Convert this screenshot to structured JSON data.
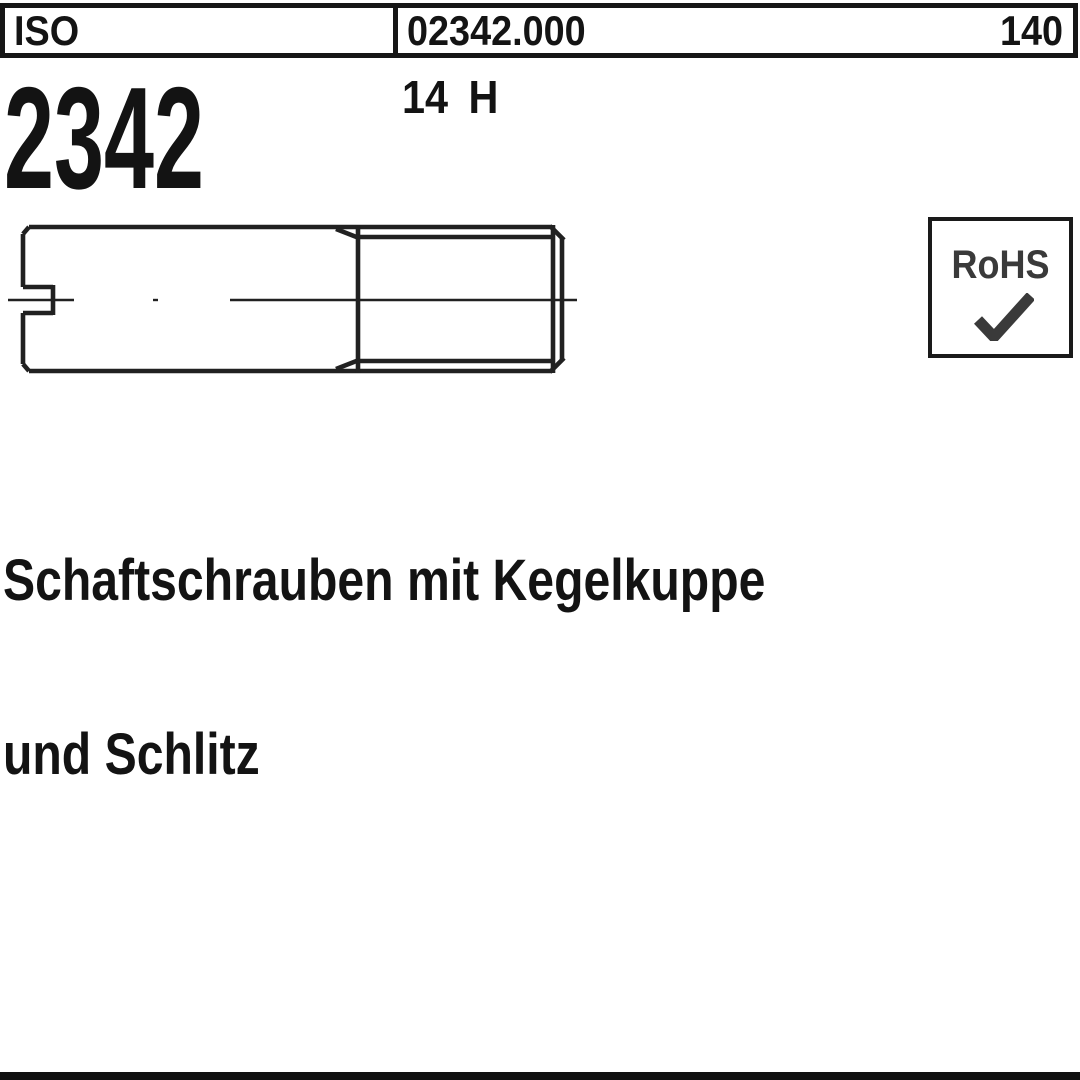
{
  "header": {
    "standard_org": "ISO",
    "article_number": "02342.000",
    "page_number": "140"
  },
  "standard": {
    "org": "ISO",
    "number": "2342"
  },
  "material_grade": "14 H",
  "rohs": {
    "label": "RoHS",
    "check_icon": "checkmark"
  },
  "title": {
    "line1": "Schaftschrauben mit Kegelkuppe",
    "line2": "und Schlitz"
  },
  "drawing": {
    "label": "slotted shaft screw side view with cone point and threaded end",
    "ink_color": "#212121",
    "centerline_style": "dash-dot"
  },
  "colors": {
    "background": "#ffffff",
    "text": "#141414",
    "border": "#161616",
    "rohs_text": "#3a3a3a",
    "bottom_bar": "#101010"
  }
}
